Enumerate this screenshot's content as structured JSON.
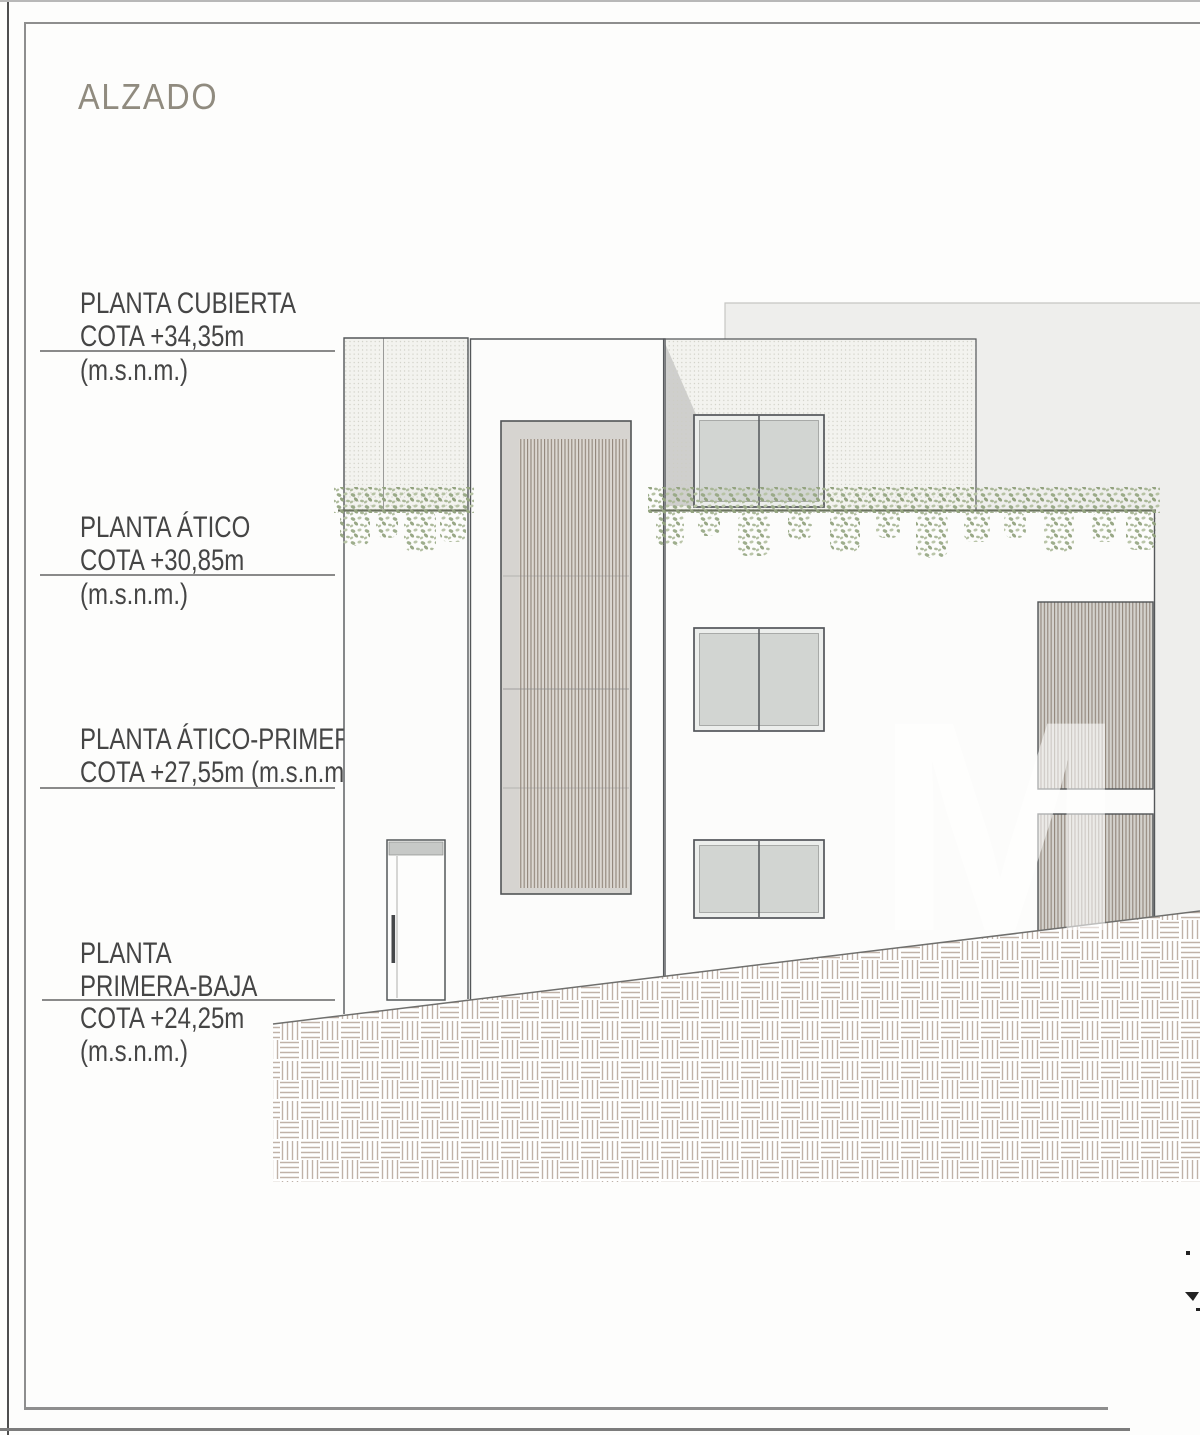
{
  "title": "ALZADO",
  "levels": [
    {
      "line1": "PLANTA CUBIERTA",
      "line2": "COTA +34,35m",
      "below1": "(m.s.n.m.)"
    },
    {
      "line1": "PLANTA ÁTICO",
      "line2": "COTA +30,85m",
      "below1": "(m.s.n.m.)"
    },
    {
      "line1": "PLANTA ÁTICO-PRIMERA",
      "line2": "COTA +27,55m (m.s.n.m.)"
    },
    {
      "line1": "PLANTA",
      "line2": "PRIMERA-BAJA",
      "below1": "COTA +24,25m",
      "below2": "(m.s.n.m.)"
    }
  ],
  "watermark": "M",
  "colors": {
    "title_text": "#908b7f",
    "label_text": "#454545",
    "drawing_line": "#54575a",
    "datum_line": "#8a8a8a",
    "stipple_dot": "#cfcfc6",
    "background_panel": "#eeeeec",
    "window_glass": "#d3d5d3",
    "louver_bg": "#dcd8d2",
    "louver_stripe": "#93887d",
    "vegetation": "#9aaa88",
    "ground_hatch": "#c0b2a8",
    "shadow": "#cfcfcd"
  }
}
